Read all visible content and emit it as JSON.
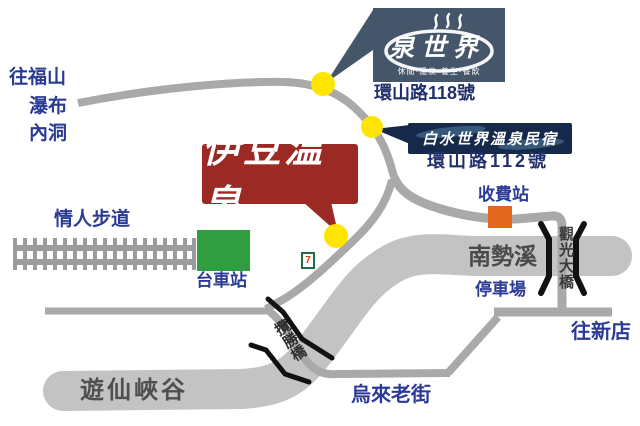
{
  "colors": {
    "road": "#a9a9a9",
    "river": "#c3c3c3",
    "marker_yellow": "#ffe400",
    "izu_red": "#9c2a24",
    "station_green": "#2f9e41",
    "toll_orange": "#e2671c",
    "spring_slate": "#46566a",
    "baishui_navy": "#16294a",
    "label_blue": "#2b3a95",
    "address_navy": "#22306b",
    "bridge_black": "#111111"
  },
  "top_left_destinations": {
    "line1": "往福山",
    "line2": "瀑布",
    "line3": "內洞"
  },
  "spring_world_sign": {
    "name": "泉世界",
    "tagline": "休閒·溫泉·養生·餐飲",
    "address": "環山路118號"
  },
  "baishui_sign": {
    "name": "白水世界溫泉民宿",
    "address": "環山路112號"
  },
  "izu_sign": {
    "name": "伊豆温泉"
  },
  "labels": {
    "lovers_trail": "情人步道",
    "cart_station": "台車站",
    "seven_eleven": "7",
    "toll_station": "收費站",
    "nanshi_river": "南勢溪",
    "parking": "停車場",
    "guanguang_bridge": "觀光大橋",
    "to_xindian": "往新店",
    "lansheng_bridge": "攬勝橋",
    "youxian_gorge": "遊仙峽谷",
    "wulai_old_street": "烏來老街"
  }
}
